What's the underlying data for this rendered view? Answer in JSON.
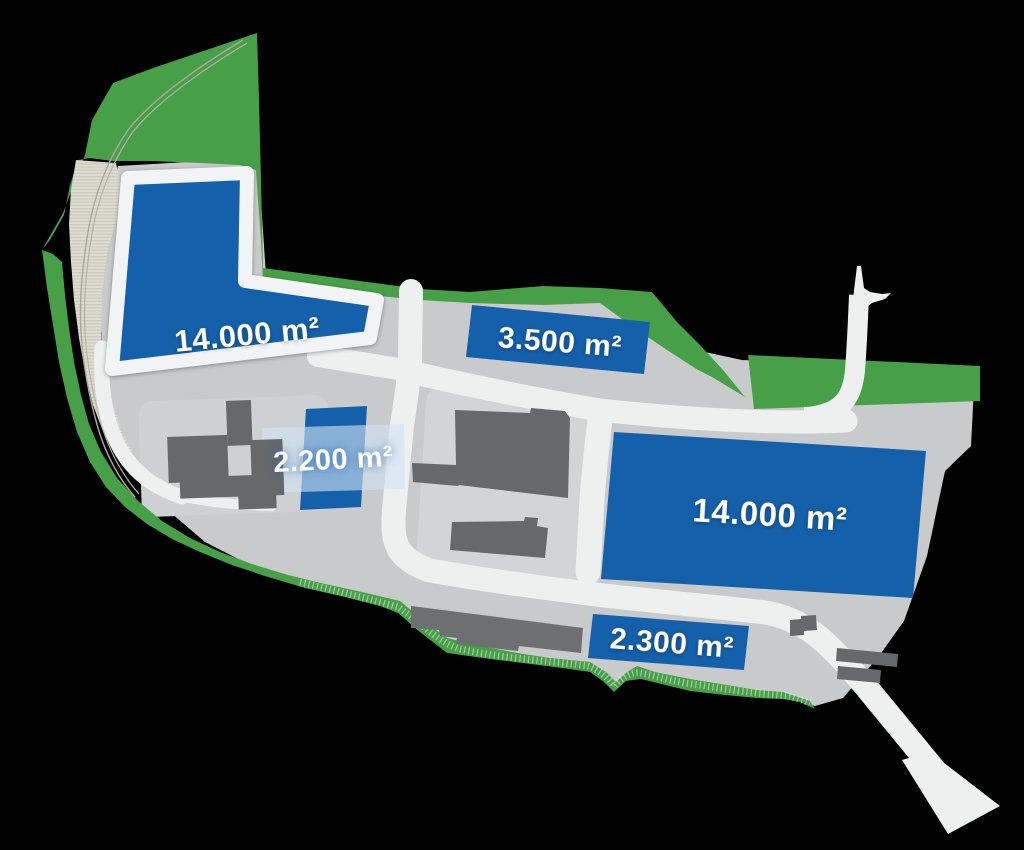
{
  "map": {
    "type": "industrial-site-plan",
    "background_color": "#000000",
    "colors": {
      "available_plot_blue": "#1560aa",
      "greenery_green": "#47a047",
      "parcel_gray": "#c9cacb",
      "parcel_pad_gray": "#d3d4d5",
      "road_white": "#eef0f0",
      "building_gray": "#66686a",
      "embankment_beige": "#dedbd1",
      "overlay_light_blue": "rgba(208,227,243,0.62)"
    },
    "plots": [
      {
        "id": "plot-1",
        "area_label": "14.000 m²"
      },
      {
        "id": "plot-2",
        "area_label": "3.500 m²"
      },
      {
        "id": "plot-3",
        "area_label": "2.200 m²"
      },
      {
        "id": "plot-4",
        "area_label": "14.000 m²"
      },
      {
        "id": "plot-5",
        "area_label": "2.300 m²"
      }
    ]
  }
}
